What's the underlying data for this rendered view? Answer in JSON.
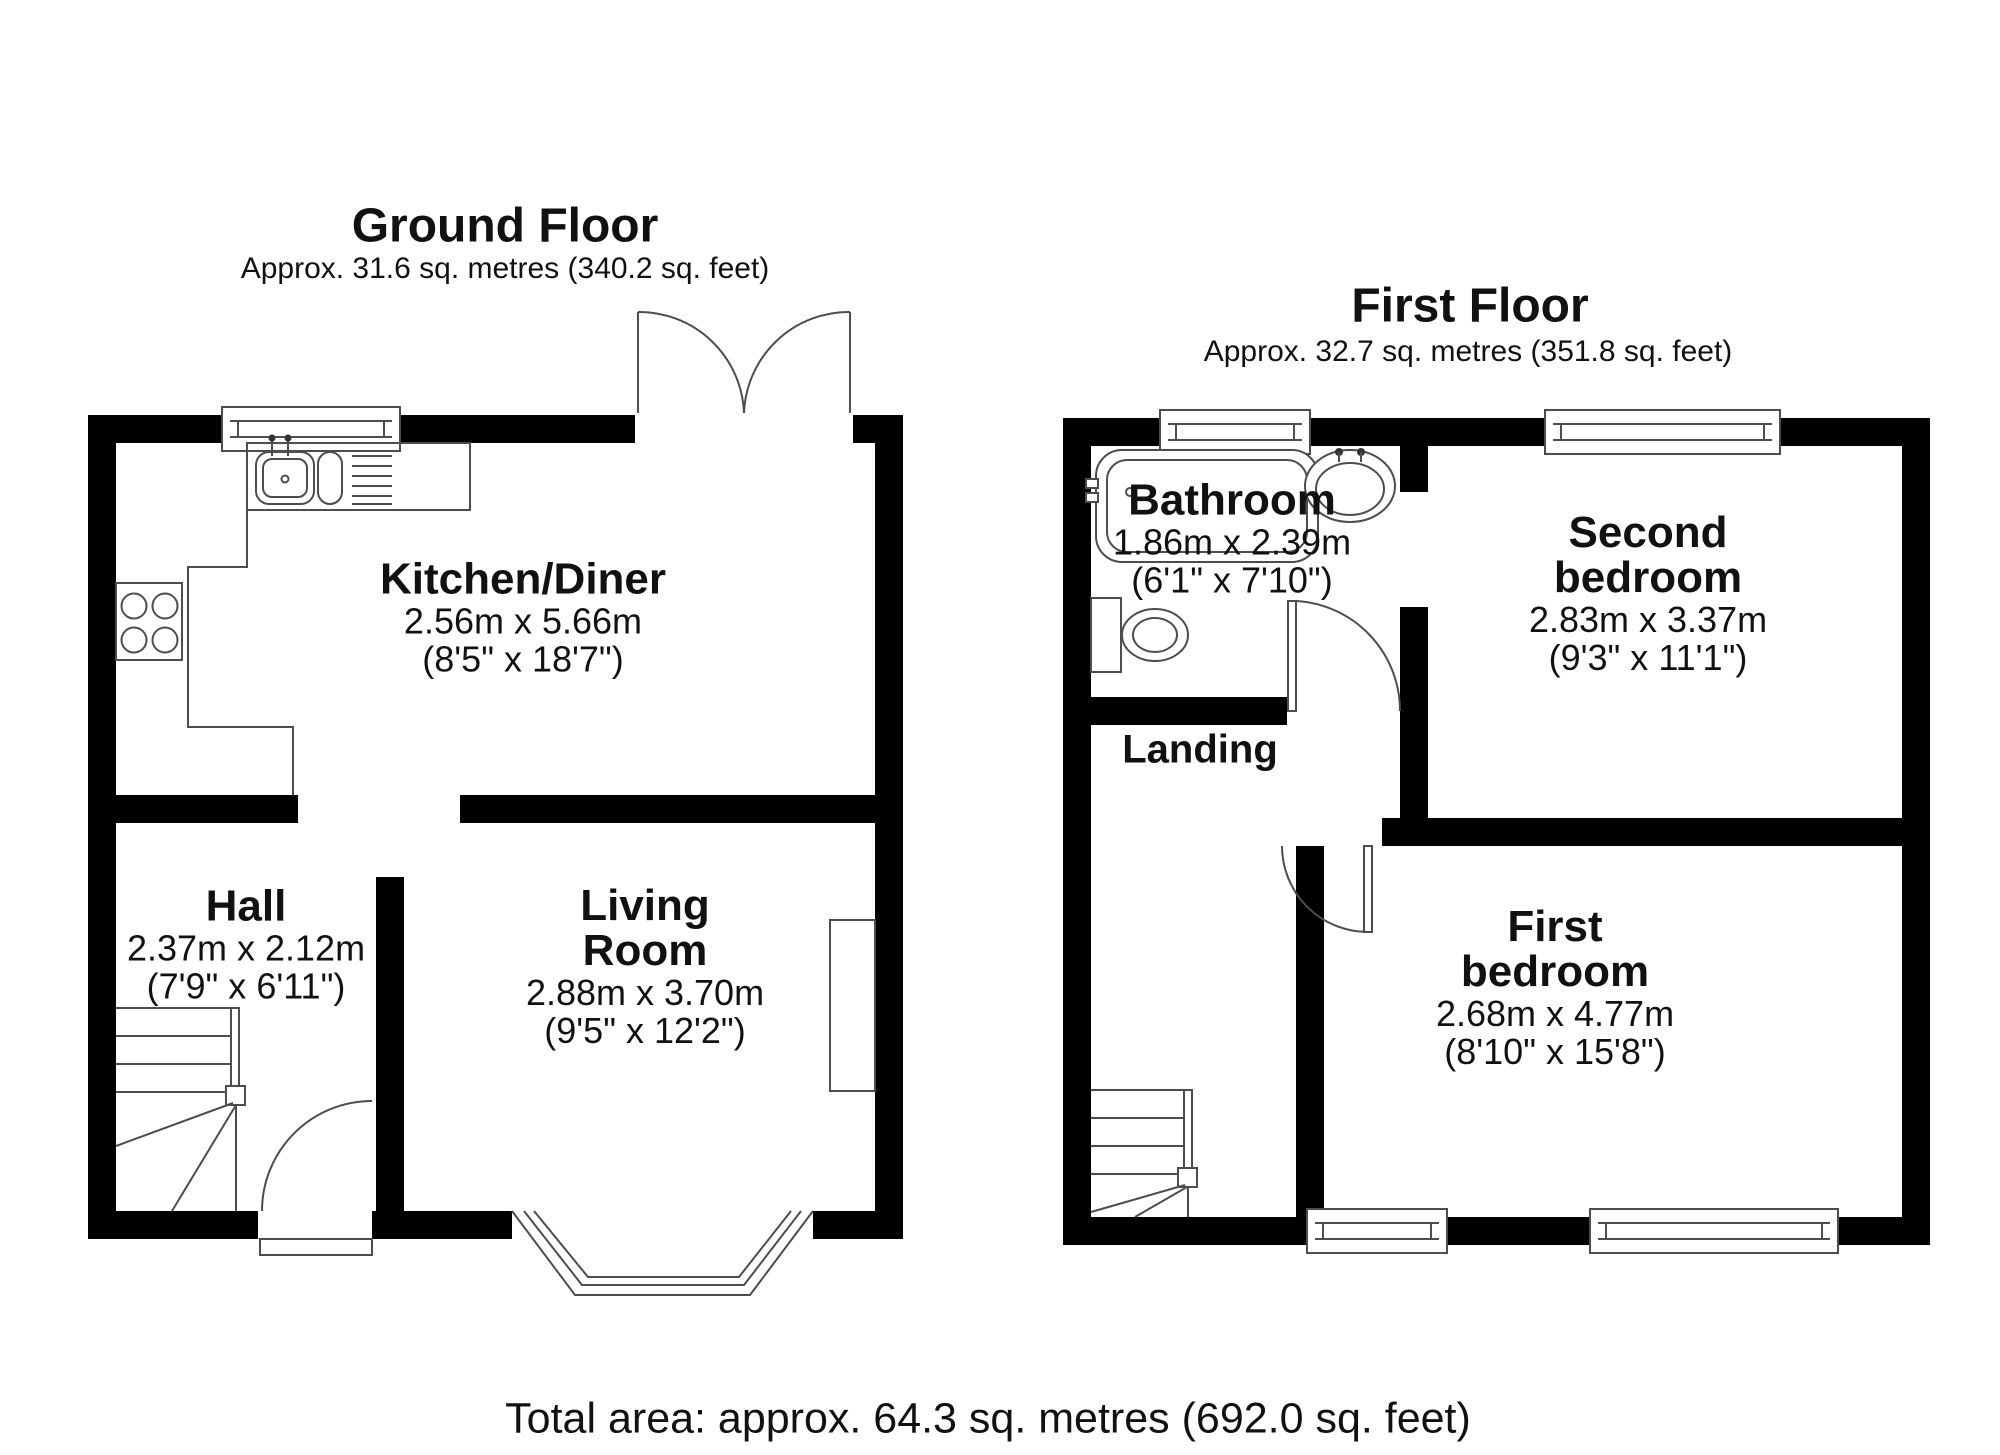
{
  "ground_floor": {
    "title": "Ground Floor",
    "area": "Approx. 31.6 sq. metres (340.2 sq. feet)",
    "rooms": {
      "kitchen": {
        "name": "Kitchen/Diner",
        "metric": "2.56m x 5.66m",
        "imperial": "(8'5\" x 18'7\")"
      },
      "hall": {
        "name": "Hall",
        "metric": "2.37m x 2.12m",
        "imperial": "(7'9\" x 6'11\")"
      },
      "living": {
        "name": "Living\nRoom",
        "metric": "2.88m x 3.70m",
        "imperial": "(9'5\" x 12'2\")"
      }
    }
  },
  "first_floor": {
    "title": "First Floor",
    "area": "Approx. 32.7 sq. metres (351.8 sq. feet)",
    "rooms": {
      "bathroom": {
        "name": "Bathroom",
        "metric": "1.86m x 2.39m",
        "imperial": "(6'1\" x 7'10\")"
      },
      "second_bedroom": {
        "name": "Second\nbedroom",
        "metric": "2.83m x 3.37m",
        "imperial": "(9'3\" x 11'1\")"
      },
      "first_bedroom": {
        "name": "First\nbedroom",
        "metric": "2.68m x 4.77m",
        "imperial": "(8'10\" x 15'8\")"
      },
      "landing": {
        "name": "Landing"
      }
    }
  },
  "total_area": "Total area: approx. 64.3 sq. metres (692.0 sq. feet)"
}
